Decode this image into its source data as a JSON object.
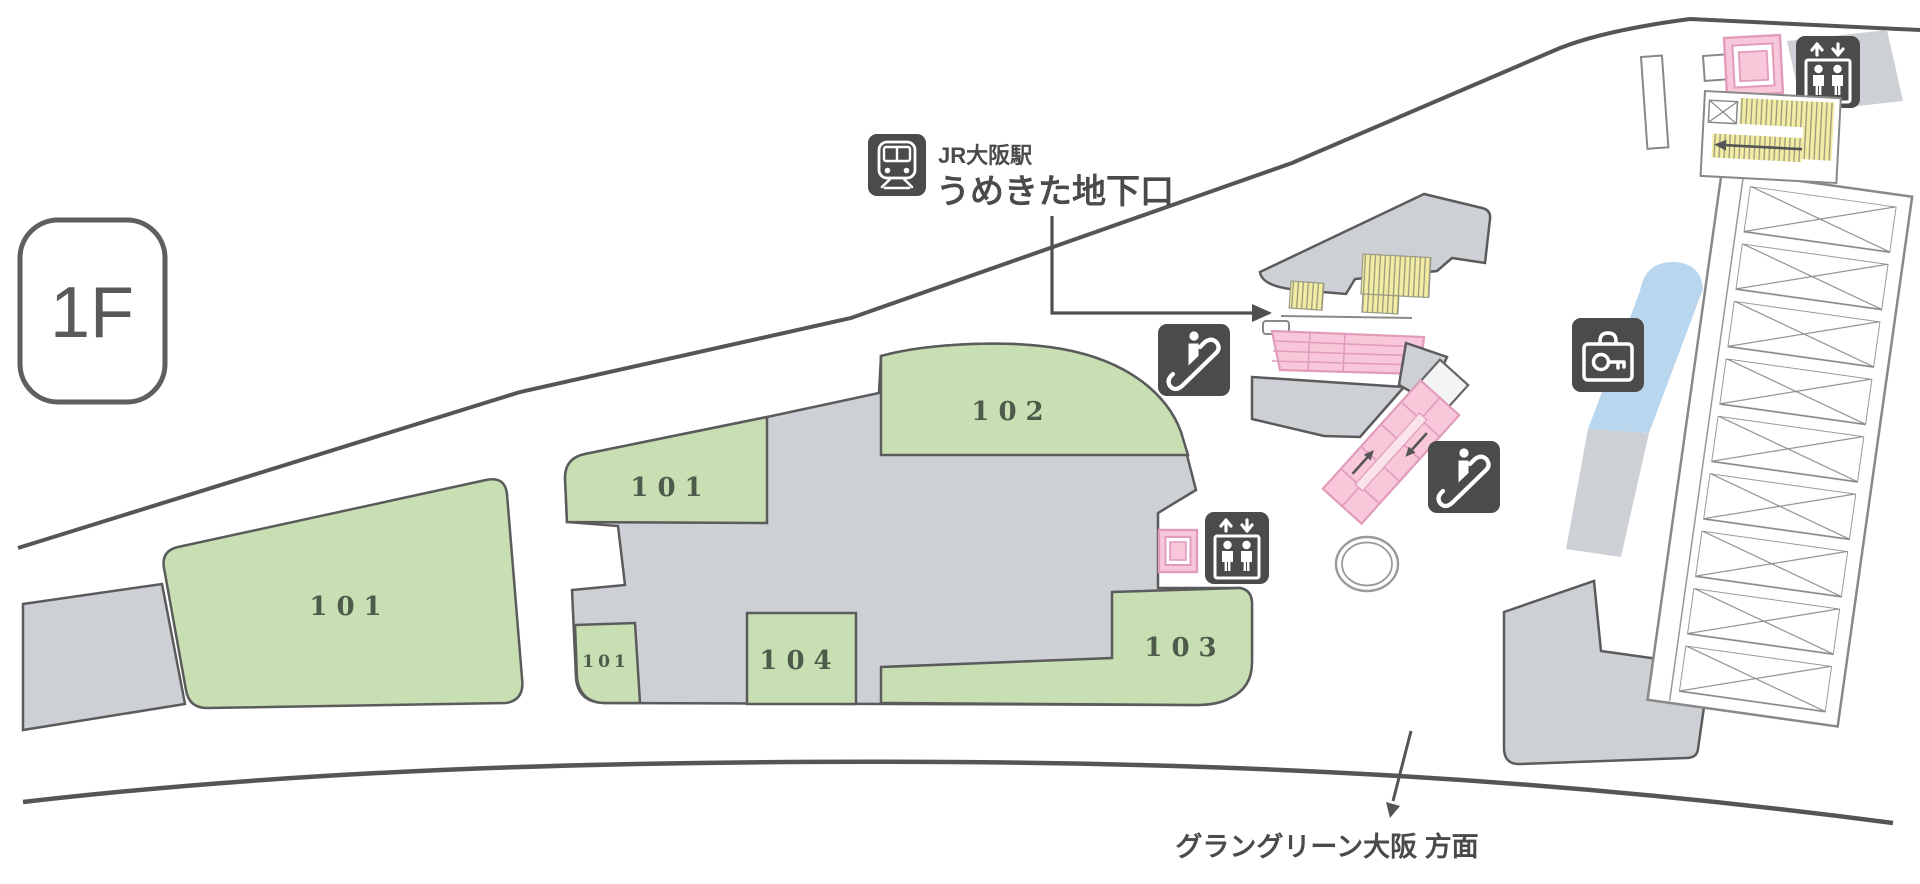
{
  "map": {
    "title": "1F floor map",
    "floor_badge": "1F",
    "station_callout": {
      "station": "JR大阪駅",
      "exit": "うめきた地下口"
    },
    "direction_label": "グラングリーン大阪 方面",
    "zones": [
      {
        "id": "101-main",
        "label": "101"
      },
      {
        "id": "101-mid",
        "label": "101"
      },
      {
        "id": "101-small",
        "label": "101"
      },
      {
        "id": "102",
        "label": "102"
      },
      {
        "id": "103",
        "label": "103"
      },
      {
        "id": "104",
        "label": "104"
      }
    ],
    "icons": [
      "train-icon",
      "escalator-icon",
      "escalator-icon",
      "elevator-icon",
      "elevator-icon",
      "coin-locker-icon",
      "stairs-yellow",
      "moving-walkway-pink",
      "round-pillar"
    ]
  },
  "colors": {
    "green": "#c7dfb2",
    "gray": "#cdd1d6",
    "yellow": "#f3eda4",
    "pink": "#f8c8da",
    "pinkd": "#e09cba",
    "blue": "#b9d6ef",
    "dark": "#4b4b4b",
    "line": "#5b5b5b",
    "road": "#555555",
    "text": "#4a4a4a",
    "zonetext": "#4e5b4a"
  }
}
